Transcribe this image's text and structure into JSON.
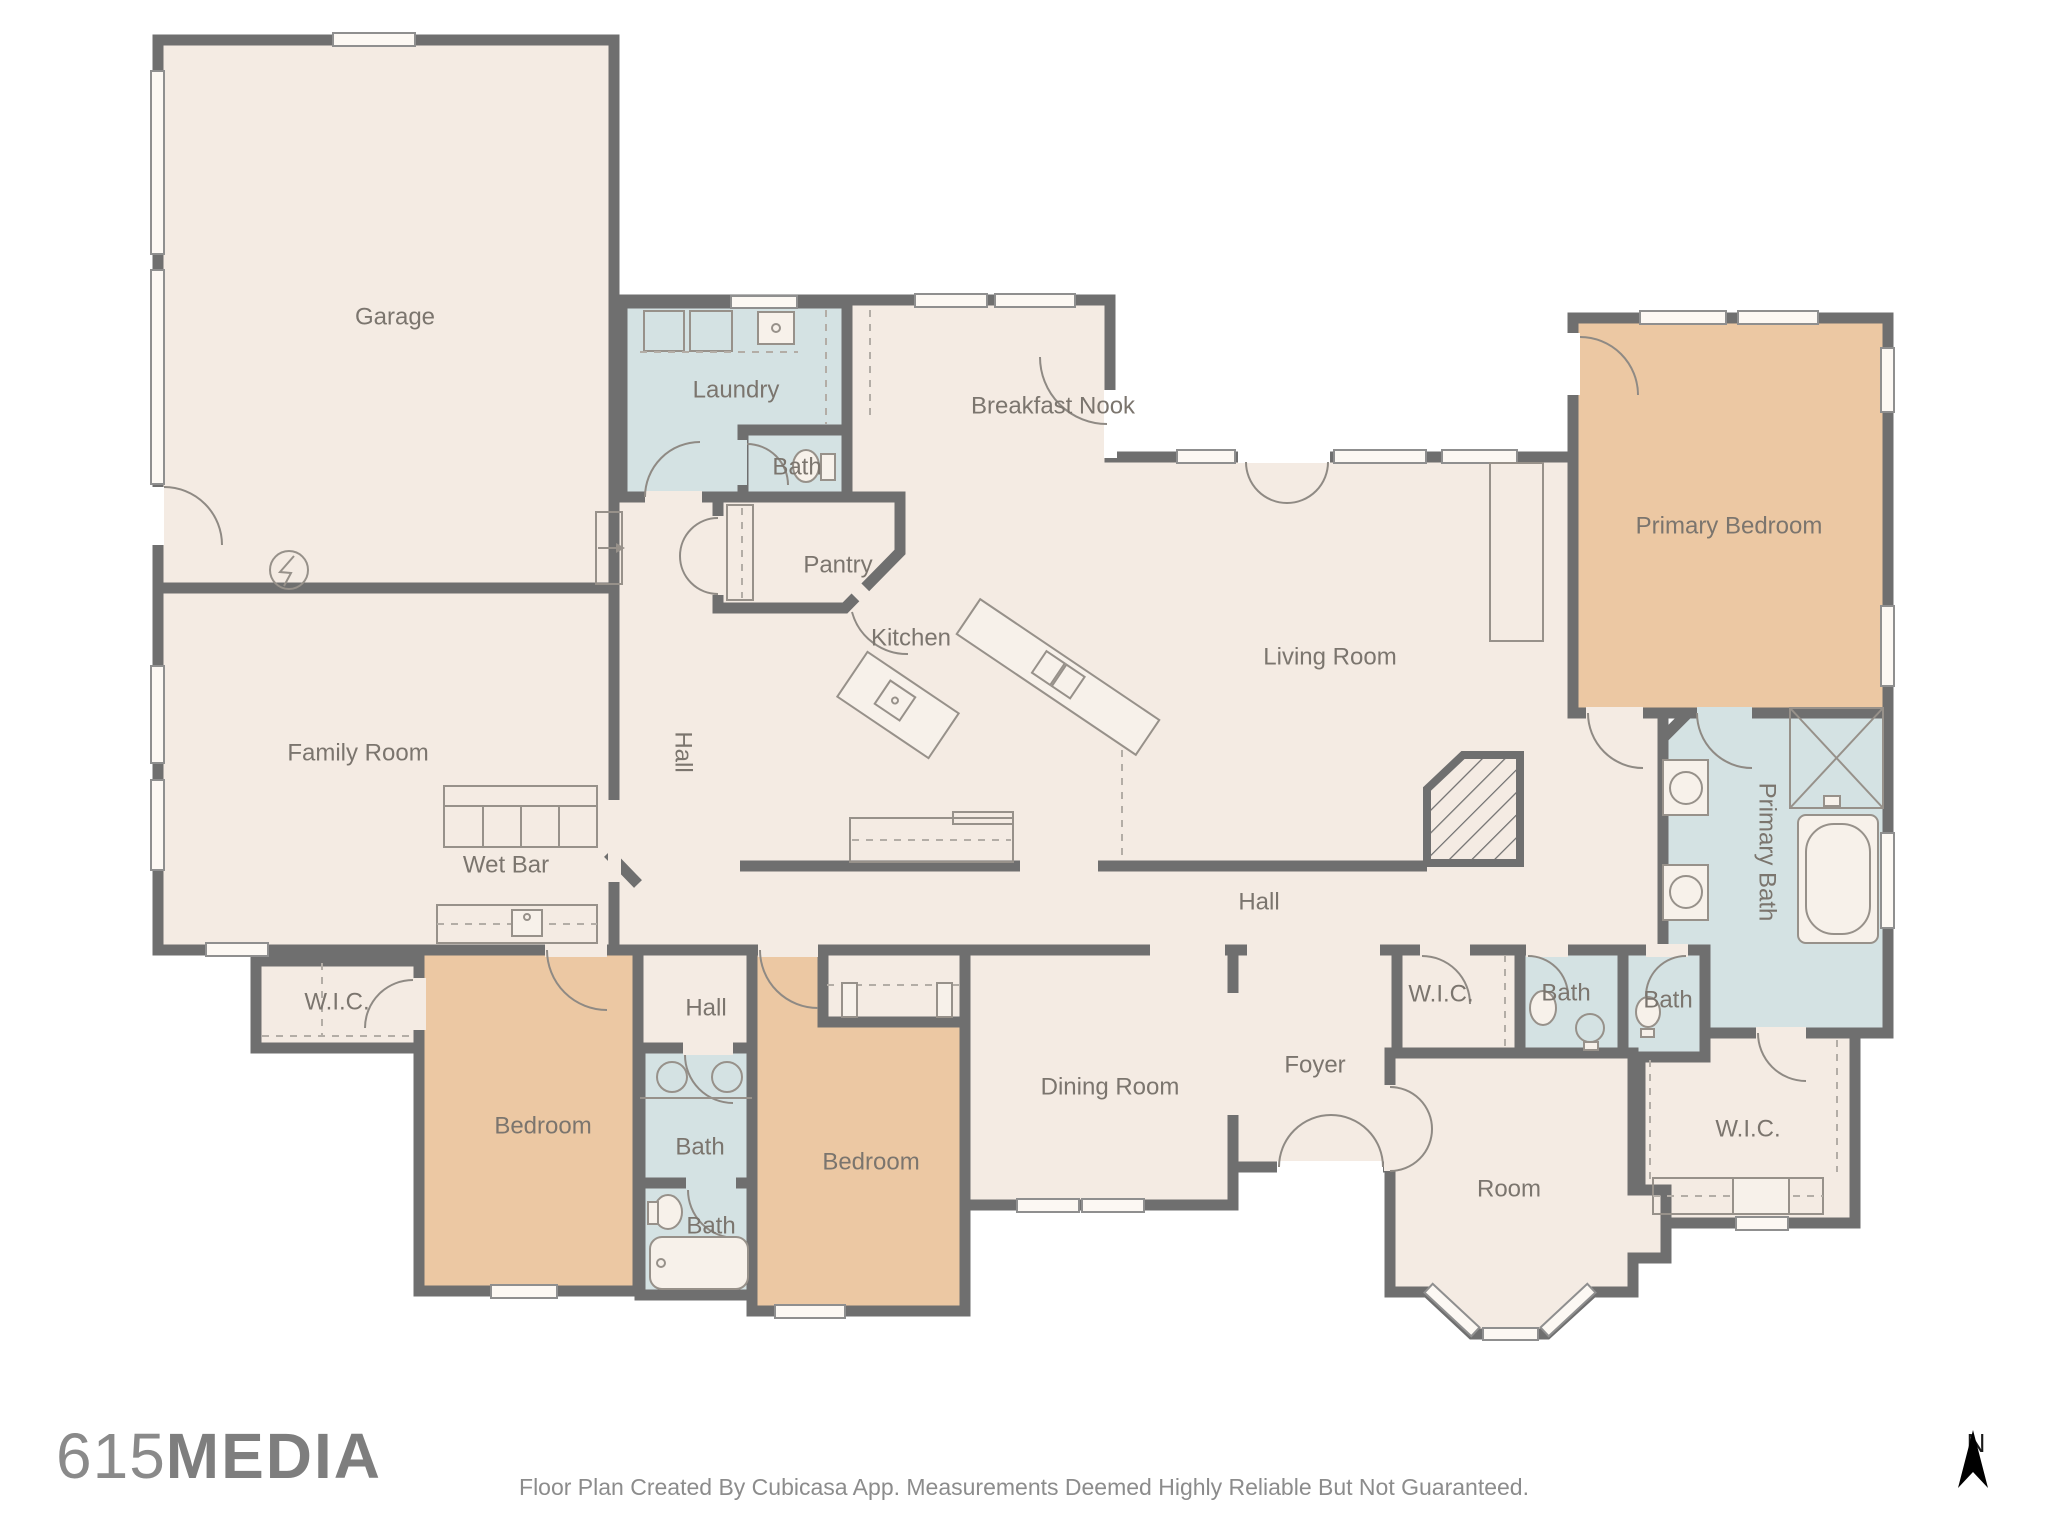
{
  "page": {
    "background": "#ffffff"
  },
  "palette": {
    "wall": "#6f6f6f",
    "floor_cream": "#f4ebe3",
    "floor_wet_rooms": "#d4e2e3",
    "floor_bedrooms": "#ecc8a3",
    "room_label": "#7b756e",
    "fixture_stroke": "#97918a",
    "logo_gray": "#8a8a8a",
    "disclaimer_gray": "#8c8c8c",
    "compass_black": "#1a1a1a"
  },
  "branding": {
    "logo_number": "615",
    "logo_word": "MEDIA"
  },
  "footer": {
    "disclaimer": "Floor Plan Created By Cubicasa App. Measurements Deemed Highly Reliable But Not Guaranteed."
  },
  "compass": {
    "label": "N"
  },
  "rooms": [
    {
      "id": "garage",
      "label": "Garage",
      "x": 395,
      "y": 318
    },
    {
      "id": "laundry",
      "label": "Laundry",
      "x": 736,
      "y": 391
    },
    {
      "id": "bath-laundry",
      "label": "Bath",
      "x": 797,
      "y": 468
    },
    {
      "id": "pantry",
      "label": "Pantry",
      "x": 838,
      "y": 566
    },
    {
      "id": "breakfast-nook",
      "label": "Breakfast Nook",
      "x": 1053,
      "y": 407
    },
    {
      "id": "kitchen",
      "label": "Kitchen",
      "x": 911,
      "y": 639
    },
    {
      "id": "living-room",
      "label": "Living Room",
      "x": 1330,
      "y": 658
    },
    {
      "id": "family-room",
      "label": "Family Room",
      "x": 358,
      "y": 754
    },
    {
      "id": "wet-bar",
      "label": "Wet Bar",
      "x": 506,
      "y": 866
    },
    {
      "id": "hall-vertical",
      "label": "Hall",
      "x": 682,
      "y": 752,
      "rotate": 90
    },
    {
      "id": "hall-main",
      "label": "Hall",
      "x": 1259,
      "y": 903
    },
    {
      "id": "hall-small",
      "label": "Hall",
      "x": 706,
      "y": 1009
    },
    {
      "id": "wic-left",
      "label": "W.I.C.",
      "x": 337,
      "y": 1003
    },
    {
      "id": "bedroom-left",
      "label": "Bedroom",
      "x": 543,
      "y": 1127
    },
    {
      "id": "bath-left",
      "label": "Bath",
      "x": 700,
      "y": 1148
    },
    {
      "id": "bath-left-lower",
      "label": "Bath",
      "x": 711,
      "y": 1227
    },
    {
      "id": "bedroom-center",
      "label": "Bedroom",
      "x": 871,
      "y": 1163
    },
    {
      "id": "dining-room",
      "label": "Dining Room",
      "x": 1110,
      "y": 1088
    },
    {
      "id": "foyer",
      "label": "Foyer",
      "x": 1315,
      "y": 1066
    },
    {
      "id": "wic-center",
      "label": "W.I.C.",
      "x": 1441,
      "y": 995
    },
    {
      "id": "bath-center",
      "label": "Bath",
      "x": 1566,
      "y": 994
    },
    {
      "id": "bath-right",
      "label": "Bath",
      "x": 1668,
      "y": 1001
    },
    {
      "id": "primary-bedroom",
      "label": "Primary Bedroom",
      "x": 1729,
      "y": 527
    },
    {
      "id": "primary-bath",
      "label": "Primary Bath",
      "x": 1766,
      "y": 852,
      "rotate": 90
    },
    {
      "id": "wic-bottom-right",
      "label": "W.I.C.",
      "x": 1748,
      "y": 1130
    },
    {
      "id": "room",
      "label": "Room",
      "x": 1509,
      "y": 1190
    }
  ]
}
